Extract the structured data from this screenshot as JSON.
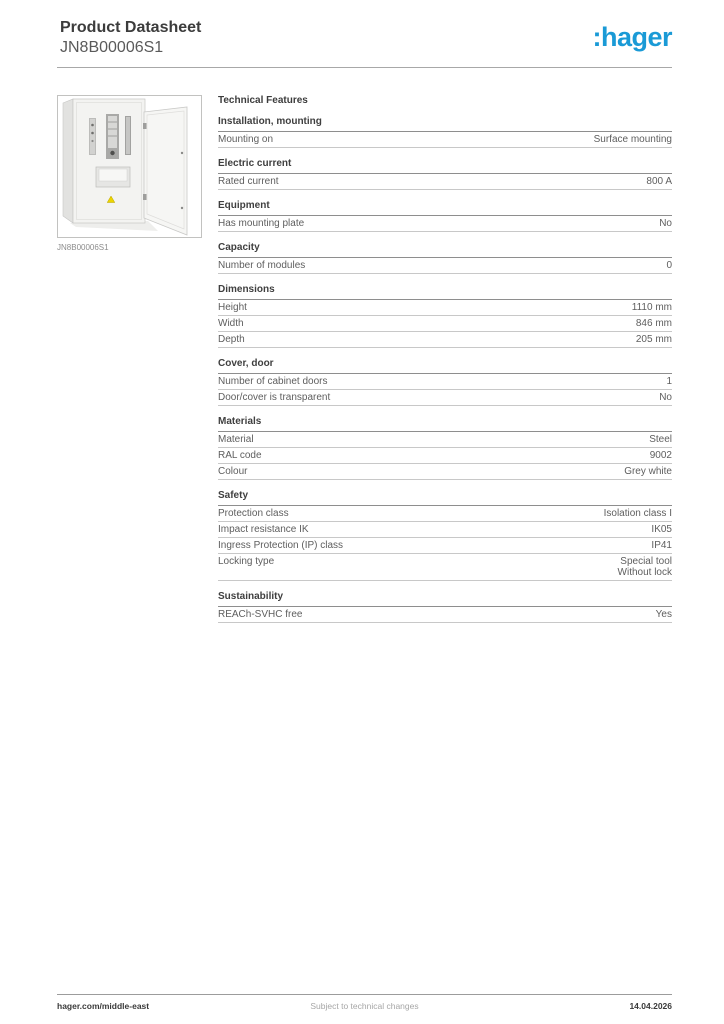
{
  "header": {
    "title": "Product Datasheet",
    "subtitle": "JN8B00006S1",
    "logo_text": ":hager",
    "logo_color": "#1a9ad6"
  },
  "product_image": {
    "caption": "JN8B00006S1",
    "description": "surface-mounted steel distribution cabinet with open door"
  },
  "table": {
    "title": "Technical Features",
    "sections": [
      {
        "header": "Installation, mounting",
        "rows": [
          {
            "label": "Mounting on",
            "value": "Surface mounting"
          }
        ]
      },
      {
        "header": "Electric current",
        "rows": [
          {
            "label": "Rated current",
            "value": "800 A"
          }
        ]
      },
      {
        "header": "Equipment",
        "rows": [
          {
            "label": "Has mounting plate",
            "value": "No"
          }
        ]
      },
      {
        "header": "Capacity",
        "rows": [
          {
            "label": "Number of modules",
            "value": "0"
          }
        ]
      },
      {
        "header": "Dimensions",
        "rows": [
          {
            "label": "Height",
            "value": "1110 mm"
          },
          {
            "label": "Width",
            "value": "846 mm"
          },
          {
            "label": "Depth",
            "value": "205 mm"
          }
        ]
      },
      {
        "header": "Cover, door",
        "rows": [
          {
            "label": "Number of cabinet doors",
            "value": "1"
          },
          {
            "label": "Door/cover is transparent",
            "value": "No"
          }
        ]
      },
      {
        "header": "Materials",
        "rows": [
          {
            "label": "Material",
            "value": "Steel"
          },
          {
            "label": "RAL code",
            "value": "9002"
          },
          {
            "label": "Colour",
            "value": "Grey white"
          }
        ]
      },
      {
        "header": "Safety",
        "rows": [
          {
            "label": "Protection class",
            "value": "Isolation class I"
          },
          {
            "label": "Impact resistance IK",
            "value": "IK05"
          },
          {
            "label": "Ingress Protection (IP) class",
            "value": "IP41"
          },
          {
            "label": "Locking type",
            "value": "Special tool\nWithout lock"
          }
        ]
      },
      {
        "header": "Sustainability",
        "rows": [
          {
            "label": "REACh-SVHC free",
            "value": "Yes"
          }
        ]
      }
    ]
  },
  "footer": {
    "left": "hager.com/middle-east",
    "center": "Subject to technical changes",
    "right": "14.04.2026"
  }
}
